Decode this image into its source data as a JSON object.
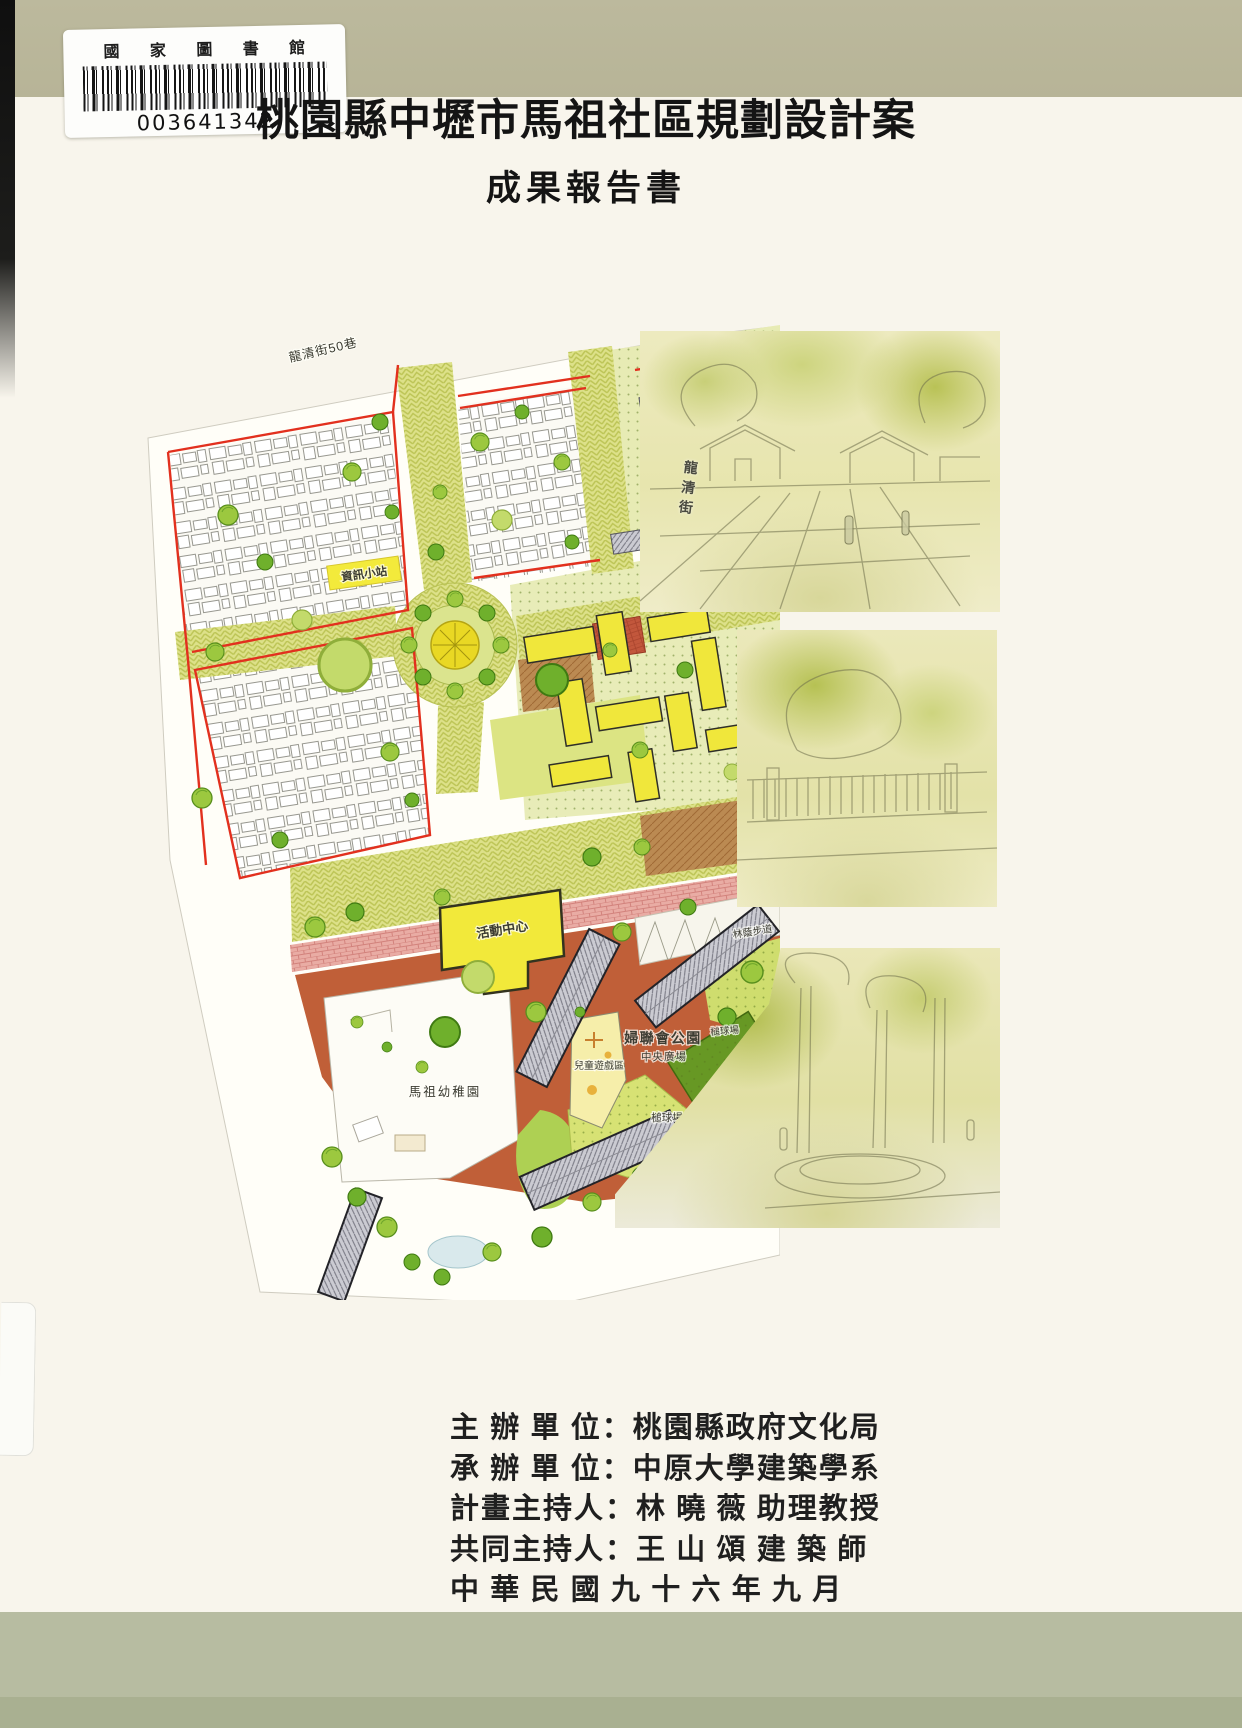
{
  "colors": {
    "cover_band": "#b8b79a",
    "paper": "#f8f5ec",
    "boundary_red": "#e2301e",
    "street_yellow": "#dde189",
    "park_terracotta": "#c05f38",
    "building_yellow": "#f2e93a"
  },
  "library_label": {
    "name": "國 家 圖 書 館",
    "barcode_number": "003641342"
  },
  "cover": {
    "title": "桃園縣中壢市馬祖社區規劃設計案",
    "subtitle": "成果報告書"
  },
  "site_plan": {
    "labels": {
      "street_top": "龍清街50巷",
      "street_right": "龍清街",
      "info_station": "資訊小站",
      "activity_center": "活動中心",
      "kindergarten": "馬祖幼稚園",
      "park_name": "婦聯會公園",
      "central_plaza": "中央廣場",
      "children_play": "兒童遊戲區",
      "croquet_court": "槌球場",
      "shaded_walk": "林蔭步道"
    }
  },
  "credits": {
    "lines": [
      "主 辦 單 位：桃園縣政府文化局",
      "承 辦 單 位：中原大學建築學系",
      "計畫主持人：林 曉 薇 助理教授",
      "共同主持人：王 山 頌 建 築 師",
      "中 華 民 國 九 十 六 年 九 月"
    ]
  }
}
